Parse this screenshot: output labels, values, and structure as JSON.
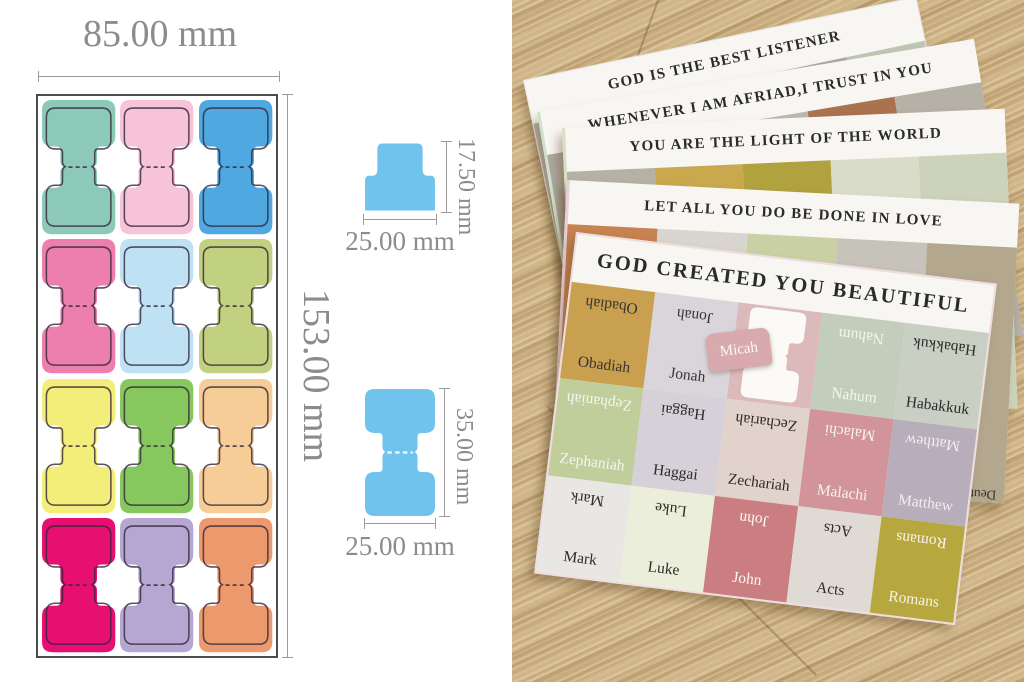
{
  "diagram": {
    "sheet_width_label": "85.00 mm",
    "sheet_height_label": "153.00 mm",
    "small_tab": {
      "height_label": "17.50 mm",
      "width_label": "25.00 mm"
    },
    "large_tab": {
      "height_label": "35.00 mm",
      "width_label": "25.00 mm"
    },
    "detail_color": "#6fc3ec",
    "dimension_color": "#9b9b9b",
    "tab_colors": [
      [
        "#8cc9b8",
        "#f6c3d8",
        "#4fa8e0"
      ],
      [
        "#ec7fad",
        "#bee2f4",
        "#c2d17f"
      ],
      [
        "#f3ee7a",
        "#86c75e",
        "#f7cd97"
      ],
      [
        "#e70f72",
        "#b5a6d2",
        "#ec9a6d"
      ]
    ]
  },
  "photo": {
    "wood": {
      "base": "#c8ab7c",
      "light": "#d8bf92",
      "dark": "#ab8d5e"
    },
    "cards": [
      {
        "title": "GOD IS THE BEST LISTENER",
        "cells": [
          {
            "label": "",
            "color": "#b9b3aa"
          },
          {
            "label": "",
            "color": "#c2879a"
          },
          {
            "label": "",
            "color": "#c3cabb"
          },
          {
            "label": "",
            "color": "#a9aaa0"
          },
          {
            "label": "",
            "color": "#c0c6b6"
          }
        ]
      },
      {
        "title": "WHENEVER I AM AFRIAD,I TRUST IN YOU",
        "cells": [
          {
            "label": "",
            "color": "#ada89f"
          },
          {
            "label": "",
            "color": "#c06571",
            "text": "#efe6de"
          },
          {
            "label": "3 John",
            "color": "#bcb9b0",
            "text": "#4a463f"
          },
          {
            "label": "Jude",
            "color": "#aa724f",
            "text": "#f3ece2"
          },
          {
            "label": "",
            "color": "#b5b1a7"
          }
        ]
      },
      {
        "title": "YOU ARE THE LIGHT OF THE WORLD",
        "cells": [
          {
            "label": "",
            "color": "#b6b1a5"
          },
          {
            "label": "",
            "color": "#c9a84e"
          },
          {
            "label": "",
            "color": "#b0a23f"
          },
          {
            "label": "",
            "color": "#dadcca"
          },
          {
            "label": "Proverbs",
            "color": "#ccd3ba",
            "text": "#4a463f"
          }
        ]
      },
      {
        "title": "LET ALL YOU DO BE DONE IN LOVE",
        "cells": [
          {
            "label": "",
            "color": "#c6824f"
          },
          {
            "label": "",
            "color": "#d8d5ce"
          },
          {
            "label": "Leviticus",
            "color": "#c9d1a4",
            "text": "#3a362f"
          },
          {
            "label": "Numbers",
            "color": "#c6c3ba",
            "text": "#3a362f"
          },
          {
            "label": "Deuteronomy",
            "color": "#b3a78d",
            "text": "#3a362f"
          }
        ]
      },
      {
        "title": "GOD CREATED YOU BEAUTIFUL",
        "grid": [
          [
            {
              "label": "Obadiah",
              "color": "#c8a050",
              "text": "#3a342e"
            },
            {
              "label": "Jonah",
              "color": "#d9d5db",
              "text": "#3a342e"
            },
            {
              "label": "Micah",
              "peeled": true,
              "backing": "#dcb9ba",
              "tab_color": "#d8a9ad",
              "text": "#fdf9f5"
            },
            {
              "label": "Nahum",
              "color": "#c2cdbb",
              "text": "#f5f5f0"
            },
            {
              "label": "Habakkuk",
              "color": "#c9cfc3",
              "text": "#2e2a28"
            }
          ],
          [
            {
              "label": "Zephaniah",
              "color": "#c0ce9b",
              "text": "#f5f5f0"
            },
            {
              "label": "Haggai",
              "color": "#d6d0d9",
              "text": "#2e2a28"
            },
            {
              "label": "Zechariah",
              "color": "#e2d2cc",
              "text": "#2e2a28"
            },
            {
              "label": "Malachi",
              "color": "#d2949a",
              "text": "#f5f5f0"
            },
            {
              "label": "Matthew",
              "color": "#b7adbb",
              "text": "#f0eef0"
            }
          ],
          [
            {
              "label": "Mark",
              "color": "#e9e7e4",
              "text": "#2e2a28"
            },
            {
              "label": "Luke",
              "color": "#ebeeda",
              "text": "#2e2a28"
            },
            {
              "label": "John",
              "color": "#cb7e81",
              "text": "#fdf9f5"
            },
            {
              "label": "Acts",
              "color": "#dfdbd4",
              "text": "#2e2a28"
            },
            {
              "label": "Romans",
              "color": "#b6a73e",
              "text": "#f7f3e8"
            }
          ]
        ]
      }
    ]
  }
}
